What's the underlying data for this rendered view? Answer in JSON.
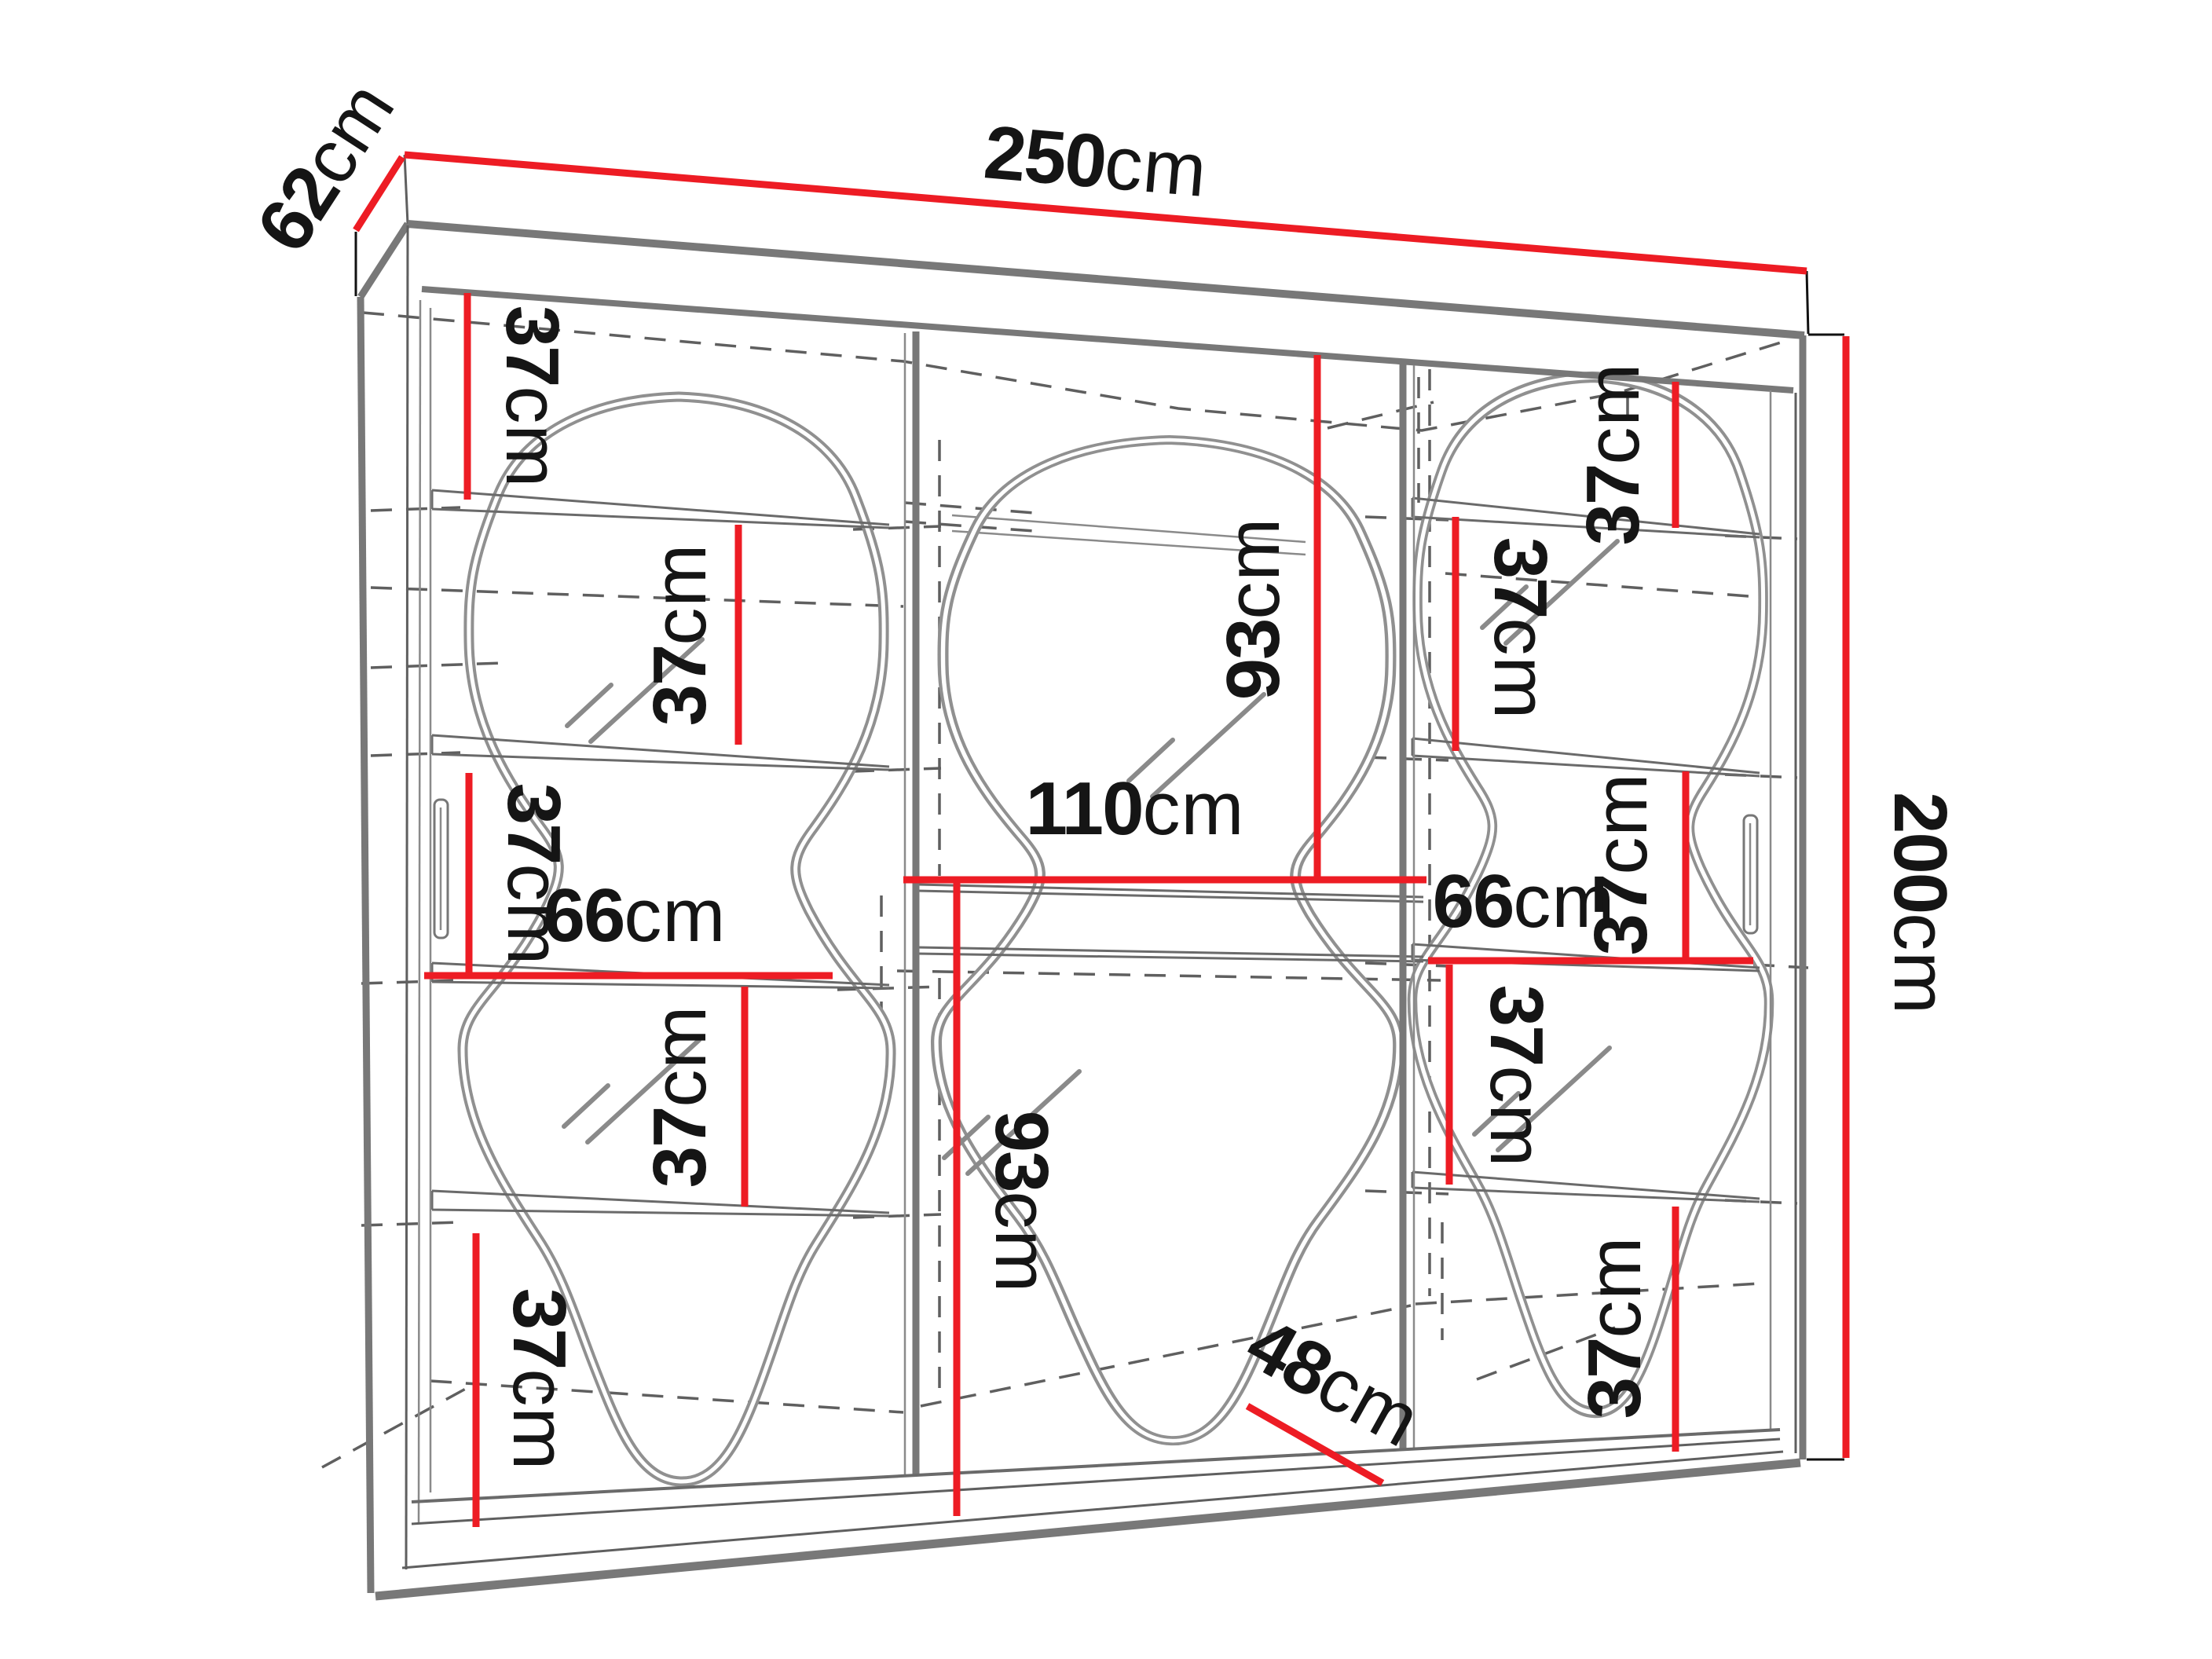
{
  "diagram": {
    "kind": "furniture-dimension-diagram",
    "subject": "three-door sliding wardrobe with wavy mirrors and side shelves",
    "background_color": "#ffffff",
    "dimension_color": "#ED1C24",
    "outline_color": "#787878",
    "text_color": "#151515",
    "overall": {
      "width": "250cm",
      "depth": "62cm",
      "height": "200cm"
    },
    "interior": {
      "left_column_shelf_gaps": [
        "37cm",
        "37cm",
        "37cm",
        "37cm",
        "37cm"
      ],
      "left_column_width": "66cm",
      "middle_upper_height": "93cm",
      "middle_width": "110cm",
      "middle_lower_height": "93cm",
      "middle_floor_depth": "48cm",
      "right_column_shelf_gaps": [
        "37cm",
        "37cm",
        "37cm",
        "37cm",
        "37cm"
      ],
      "right_column_width": "66cm"
    }
  },
  "labels": [
    {
      "value": "250",
      "unit": "cm",
      "refers_to": "overall width"
    },
    {
      "value": "62",
      "unit": "cm",
      "refers_to": "overall depth"
    },
    {
      "value": "200",
      "unit": "cm",
      "refers_to": "overall height"
    },
    {
      "value": "37",
      "unit": "cm",
      "refers_to": "left column gap 1 (top)"
    },
    {
      "value": "37",
      "unit": "cm",
      "refers_to": "left column gap 2"
    },
    {
      "value": "37",
      "unit": "cm",
      "refers_to": "left column gap 3"
    },
    {
      "value": "66",
      "unit": "cm",
      "refers_to": "left column width"
    },
    {
      "value": "37",
      "unit": "cm",
      "refers_to": "left column gap 4"
    },
    {
      "value": "37",
      "unit": "cm",
      "refers_to": "left column gap 5 (bottom)"
    },
    {
      "value": "93",
      "unit": "cm",
      "refers_to": "middle upper section height"
    },
    {
      "value": "110",
      "unit": "cm",
      "refers_to": "middle section width"
    },
    {
      "value": "93",
      "unit": "cm",
      "refers_to": "middle lower section height"
    },
    {
      "value": "48",
      "unit": "cm",
      "refers_to": "middle floor depth"
    },
    {
      "value": "37",
      "unit": "cm",
      "refers_to": "right column gap 1 (top)"
    },
    {
      "value": "37",
      "unit": "cm",
      "refers_to": "right column gap 2"
    },
    {
      "value": "37",
      "unit": "cm",
      "refers_to": "right column gap 3"
    },
    {
      "value": "66",
      "unit": "cm",
      "refers_to": "right column width"
    },
    {
      "value": "37",
      "unit": "cm",
      "refers_to": "right column gap 4"
    },
    {
      "value": "37",
      "unit": "cm",
      "refers_to": "right column gap 5 (bottom)"
    }
  ]
}
